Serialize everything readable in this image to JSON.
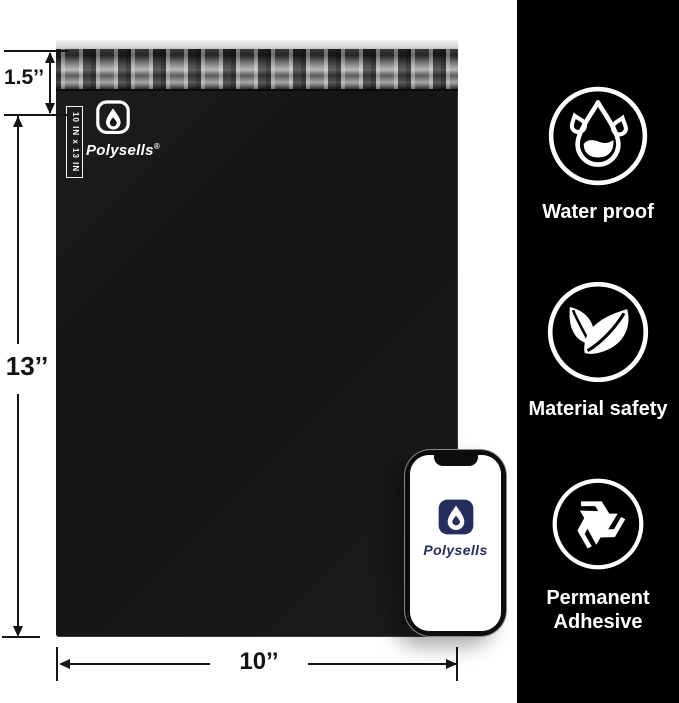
{
  "colors": {
    "sidebar_bg": "#000000",
    "bag_black": "#171717",
    "seal_silver": "#9a9a9a",
    "brand_navy": "#252d5e",
    "annotation_ink": "#141414"
  },
  "bag": {
    "brand": "Polysells",
    "registered_mark": "®",
    "size_tag_vertical": "10 IN x 13 IN"
  },
  "annotations": {
    "flap_height": "1.5’’",
    "bag_height": "13’’",
    "bag_width": "10’’"
  },
  "phone": {
    "brand": "Polysells"
  },
  "sidebar": {
    "features": [
      {
        "icon": "water-drop-icon",
        "label": "Water proof"
      },
      {
        "icon": "leaves-icon",
        "label": "Material safety"
      },
      {
        "icon": "recycle-icon",
        "label": "Permanent Adhesive"
      }
    ]
  }
}
